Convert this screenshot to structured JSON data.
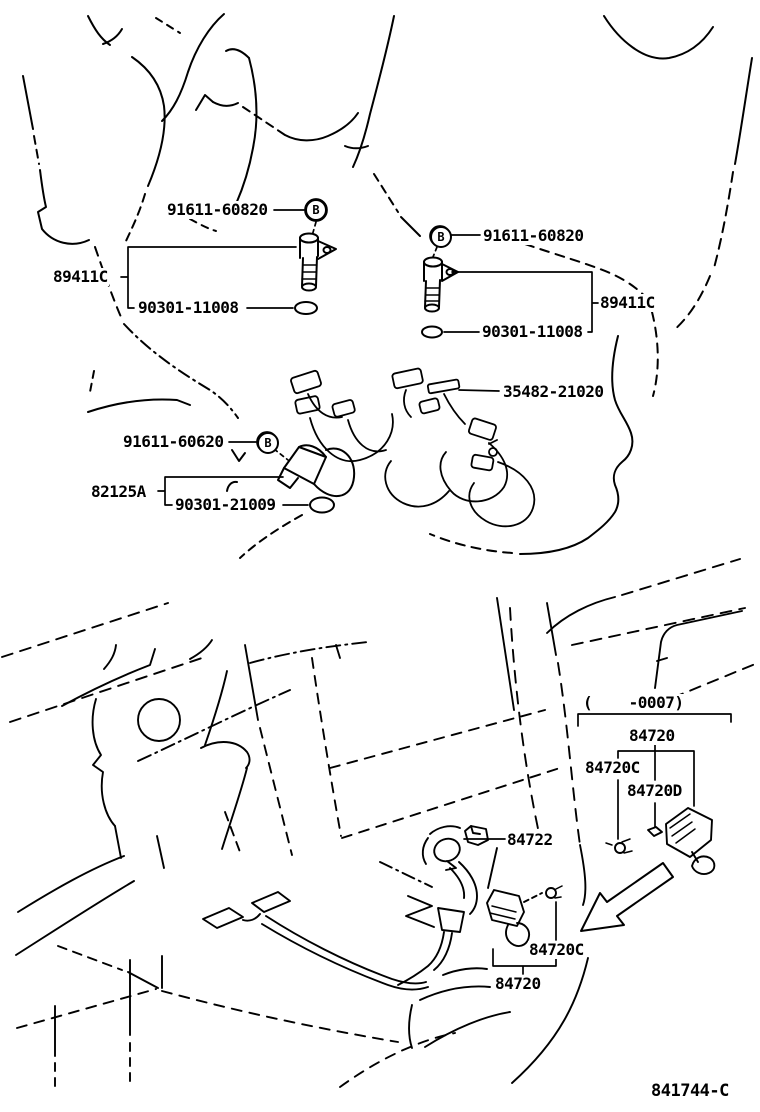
{
  "figure_code": "841744-C",
  "bolt_marker": "B",
  "engine": {
    "cam_sensor_left": {
      "part": "89411C",
      "bolt": "91611-60820",
      "oring": "90301-11008"
    },
    "cam_sensor_right": {
      "part": "89411C",
      "bolt": "91611-60820",
      "oring": "90301-11008"
    },
    "knock_sensor": {
      "part": "82125A",
      "bolt": "91611-60620",
      "oring": "90301-21009",
      "harness": "35482-21020"
    }
  },
  "interior": {
    "production_range": "(    -0007)",
    "switch_assy_early": {
      "switch": "84720",
      "screw": "84720C",
      "grommet": "84720D"
    },
    "shift_lever": "84722",
    "switch_assy": {
      "switch": "84720",
      "screw": "84720C"
    }
  }
}
